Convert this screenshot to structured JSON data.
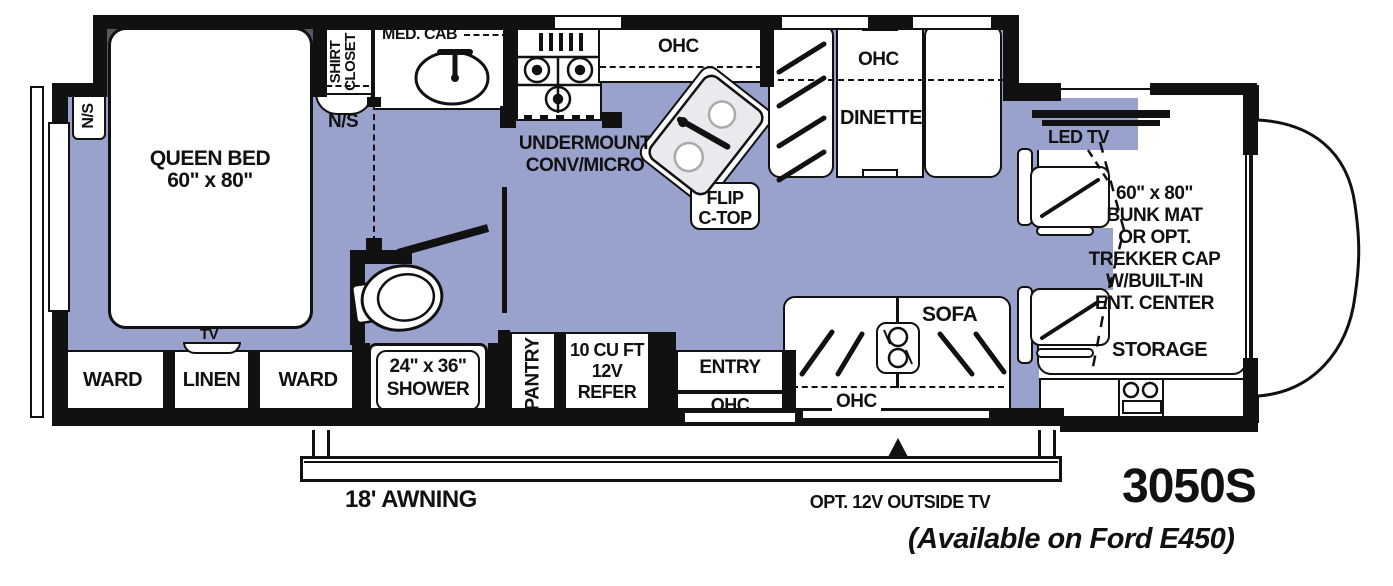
{
  "title": {
    "model": "3050S",
    "availability": "(Available on Ford E450)"
  },
  "colors": {
    "floor": "#99A2CC",
    "wall": "#111111",
    "slide_shadow": "#555a61",
    "sink_fill": "#e9e9ee"
  },
  "labels": {
    "ns_left": "N/S",
    "ns_right": "N/S",
    "shirt_closet": [
      "SHIRT",
      "CLOSET"
    ],
    "med_cab": "MED. CAB",
    "queen_bed": [
      "QUEEN BED",
      "60\" x 80\""
    ],
    "undermount": [
      "UNDERMOUNT",
      "CONV/MICRO"
    ],
    "kitchen_ohc": "OHC",
    "flip_ctop": [
      "FLIP",
      "C-TOP"
    ],
    "dinette_ohc": "OHC",
    "dinette": "DINETTE",
    "led_tv": "LED TV",
    "bunk": [
      "60\" x 80\"",
      "BUNK MAT",
      "OR OPT.",
      "TREKKER CAP",
      "W/BUILT-IN",
      "ENT. CENTER"
    ],
    "storage": "STORAGE",
    "sofa": "SOFA",
    "sofa_ohc": "OHC",
    "entry": "ENTRY",
    "entry_ohc": "OHC",
    "pantry": "PANTRY",
    "refer": [
      "10 CU FT",
      "12V",
      "REFER"
    ],
    "shower": [
      "24\" x 36\"",
      "SHOWER"
    ],
    "ward_left": "WARD",
    "linen": "LINEN",
    "ward_right": "WARD",
    "tv": "TV",
    "awning": "18' AWNING",
    "outside_tv": "OPT. 12V OUTSIDE TV"
  }
}
